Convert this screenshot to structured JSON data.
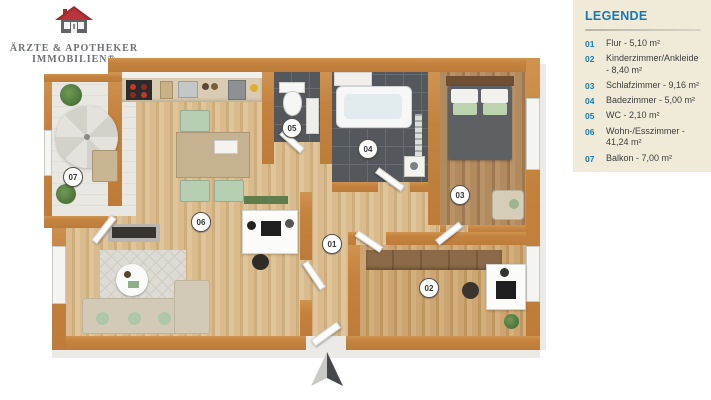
{
  "logo": {
    "line1": "ÄRZTE & APOTHEKER",
    "line2": "IMMOBILIEN®"
  },
  "legend": {
    "title": "LEGENDE",
    "items": [
      {
        "num": "01",
        "label": "Flur - 5,10 m²"
      },
      {
        "num": "02",
        "label": "Kinderzimmer/Ankleide - 8,40 m²"
      },
      {
        "num": "03",
        "label": "Schlafzimmer - 9,16 m²"
      },
      {
        "num": "04",
        "label": "Badezimmer - 5,00 m²"
      },
      {
        "num": "05",
        "label": "WC - 2,10 m²"
      },
      {
        "num": "06",
        "label": "Wohn-/Esszimmer - 41,24 m²"
      },
      {
        "num": "07",
        "label": "Balkon - 7,00 m²"
      }
    ]
  },
  "plan": {
    "badges": [
      {
        "num": "01"
      },
      {
        "num": "02"
      },
      {
        "num": "03"
      },
      {
        "num": "04"
      },
      {
        "num": "05"
      },
      {
        "num": "06"
      },
      {
        "num": "07"
      }
    ],
    "colors": {
      "wall_orange": "#c4823f",
      "accent_blue": "#1779b3",
      "legend_background": "#f0ebd8",
      "logo_roof_red": "#9e2b30",
      "tile_dark": "#54585c"
    }
  }
}
